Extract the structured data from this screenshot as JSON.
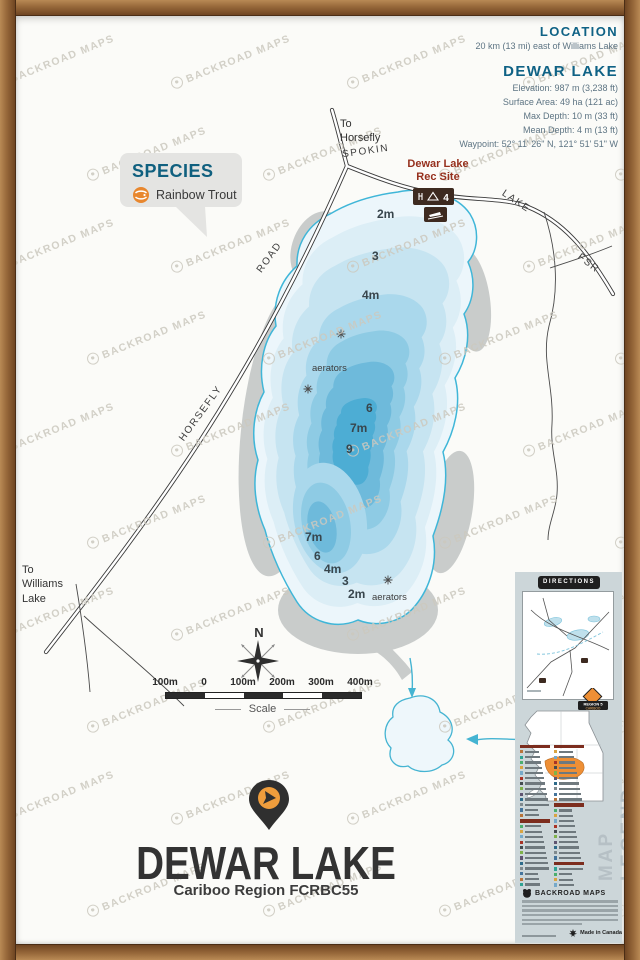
{
  "watermark": {
    "text": "BACKROAD MAPS"
  },
  "header": {
    "location_title": "LOCATION",
    "location_subtitle": "20 km (13 mi) east of Williams Lake",
    "lake_title": "DEWAR LAKE",
    "stats": [
      "Elevation: 987 m (3,238 ft)",
      "Surface Area: 49 ha (121 ac)",
      "Max Depth: 10 m (33 ft)",
      "Mean Depth: 4 m (13 ft)",
      "Waypoint: 52° 11' 26\" N, 121° 51' 51\" W"
    ]
  },
  "species": {
    "title": "SPECIES",
    "fish": "Rainbow Trout"
  },
  "map": {
    "labels": {
      "to_horsefly_1": "To",
      "to_horsefly_2": "Horsefly",
      "to_williams_1": "To",
      "to_williams_2": "Williams",
      "to_williams_3": "Lake",
      "horsefly": "HORSEFLY",
      "road": "ROAD",
      "spokin": "SPOKIN",
      "lake": "LAKE",
      "fsr": "FSR",
      "rec_site_1": "Dewar Lake",
      "rec_site_2": "Rec Site",
      "rec_badge_count": "4",
      "aerators": "aerators",
      "compass_north": "N"
    },
    "depth_labels": [
      "2m",
      "3",
      "4m",
      "6",
      "7m",
      "9",
      "7m",
      "6",
      "4m",
      "3",
      "2m"
    ],
    "scale": {
      "ticks": [
        "100m",
        "0",
        "100m",
        "200m",
        "300m",
        "400m"
      ],
      "caption": "Scale"
    }
  },
  "footer": {
    "title": "DEWAR LAKE",
    "subtitle": "Cariboo Region FCRBC55"
  },
  "side_panel": {
    "directions_title": "DIRECTIONS",
    "region_badge_line1": "REGION 5",
    "region_badge_line2": "CARIBOO",
    "legend_vertical": "MAP LEGEND",
    "brand": "BACKROAD MAPS",
    "made_in": "Made in Canada"
  },
  "colors": {
    "teal_heading": "#0f6285",
    "rec_site_red": "#96301d",
    "lake_outline": "#3fb6d8",
    "depth_fills": [
      "#ecf6fb",
      "#dceef6",
      "#c6e4f1",
      "#aad8ec",
      "#8ecbe4",
      "#6ebadb",
      "#4dadd4"
    ],
    "marsh_gray": "#c9cccb",
    "accent_orange": "#ee8f35",
    "wood_frame": "#97683a"
  }
}
